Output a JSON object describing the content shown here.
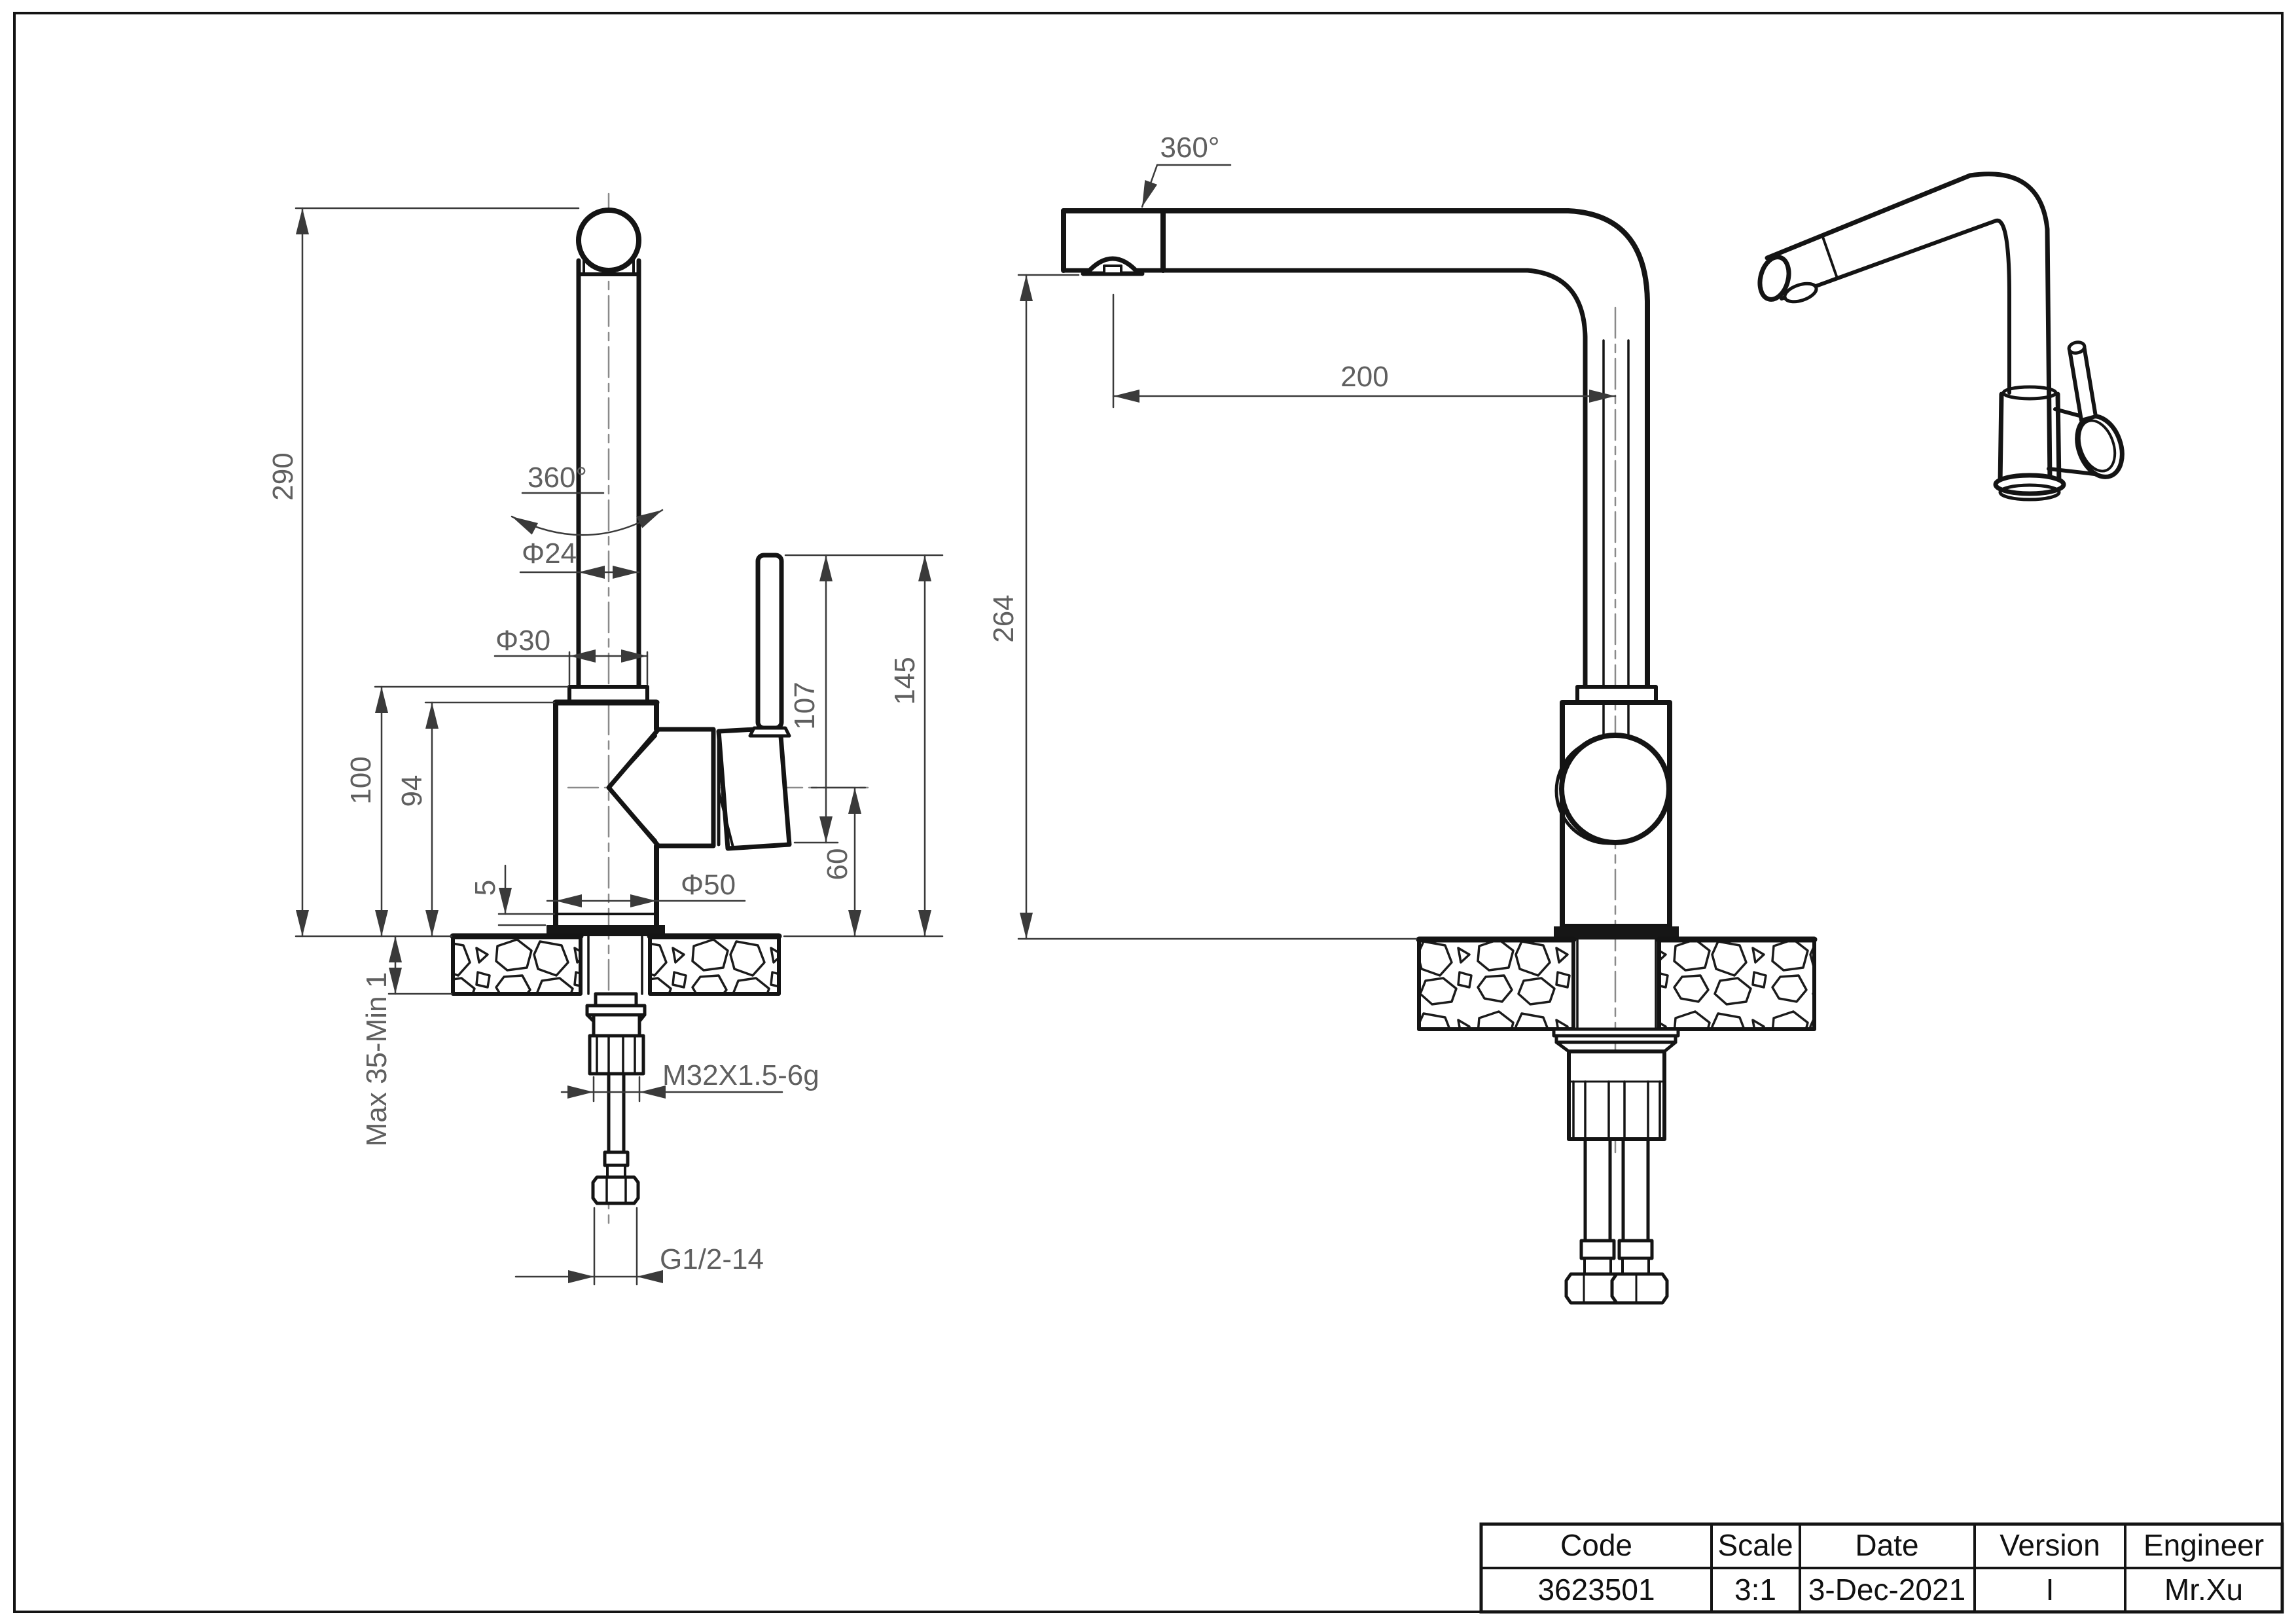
{
  "drawing_title": "Kitchen faucet engineering drawing",
  "colors": {
    "background": "#ffffff",
    "outline": "#141414",
    "dim_line": "#3a3a3a",
    "dim_text": "#5f5f5f",
    "centerline": "#8a8a8a"
  },
  "front_view": {
    "name": "front view",
    "dims": {
      "d290": "290",
      "d100": "100",
      "d94": "94",
      "d5": "5",
      "dia24": "Φ24",
      "dia30": "Φ30",
      "dia50": "Φ50",
      "d107": "107",
      "d60": "60",
      "d145": "145",
      "rot": "360°",
      "deck": "Max 35-Min 1",
      "thread": "M32X1.5-6g",
      "hose": "G1/2-14"
    }
  },
  "side_view": {
    "name": "side view",
    "dims": {
      "d200": "200",
      "d264": "264",
      "rot": "360°"
    }
  },
  "iso_view": {
    "name": "isometric view"
  },
  "title_block": {
    "headers": {
      "code": "Code",
      "scale": "Scale",
      "date": "Date",
      "version": "Version",
      "engineer": "Engineer"
    },
    "values": {
      "code": "3623501",
      "scale": "3:1",
      "date": "3-Dec-2021",
      "version": "I",
      "engineer": "Mr.Xu"
    }
  }
}
